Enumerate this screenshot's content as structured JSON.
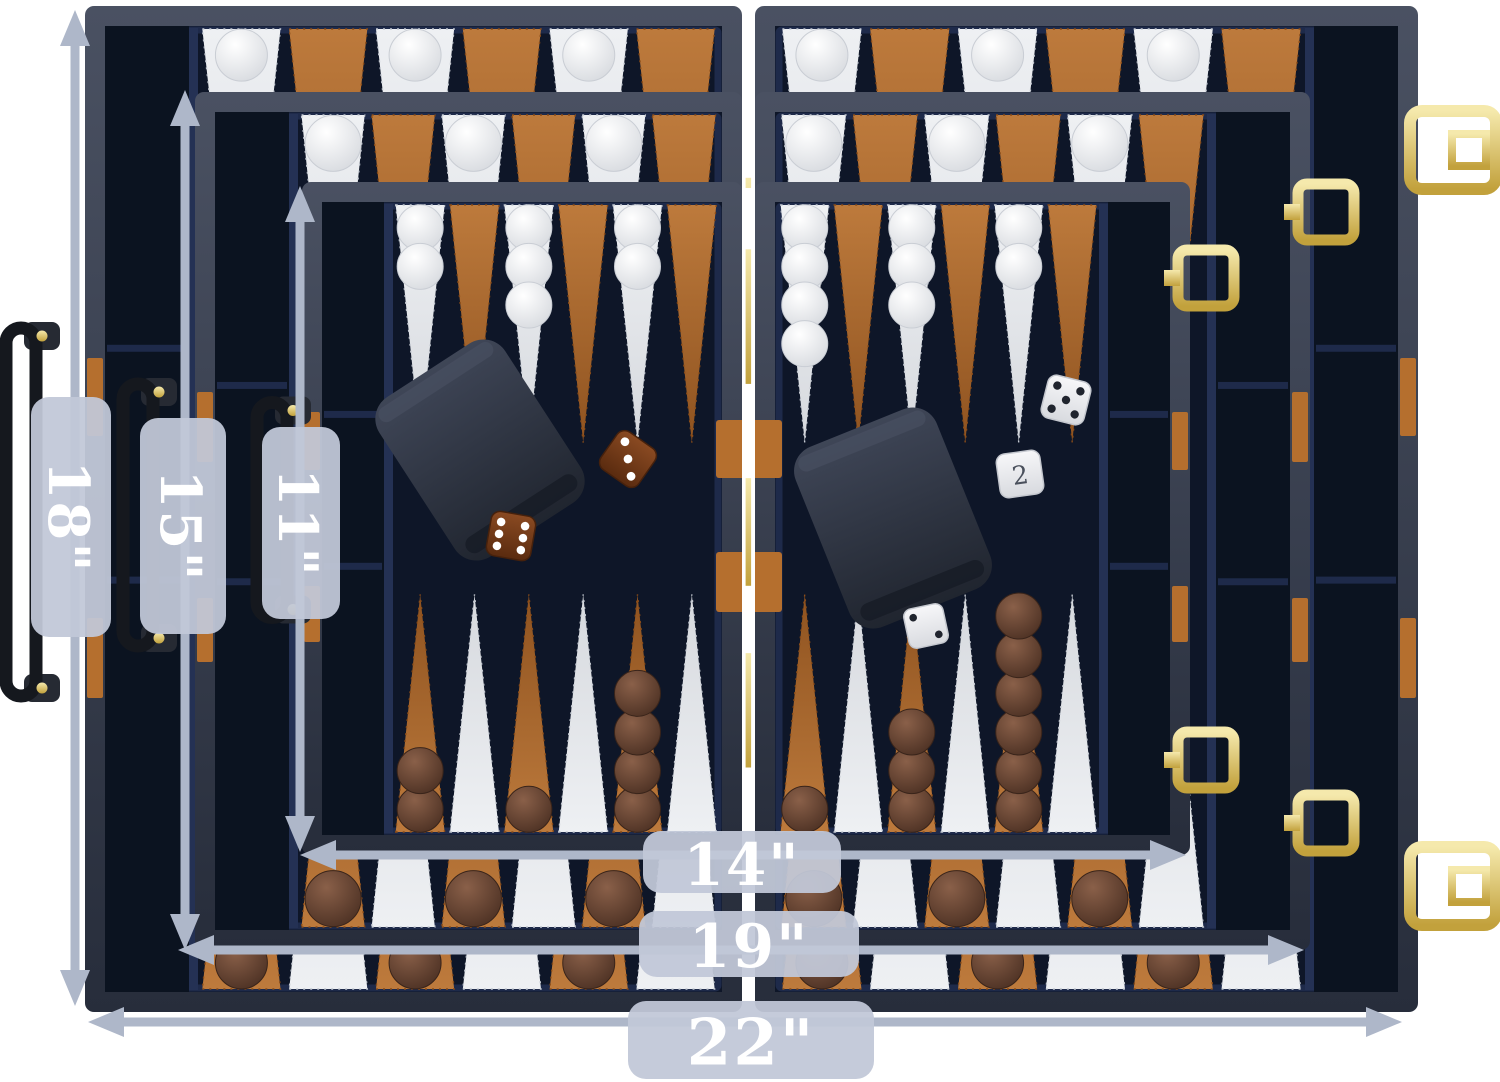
{
  "image_type": "product-photo",
  "subject": "Three nested folding backgammon cases shown open for size comparison",
  "dimension_labels": {
    "h18": "18\"",
    "h15": "15\"",
    "h11": "11\"",
    "w14": "14\"",
    "w19": "19\"",
    "w22": "22\""
  },
  "doubling_cube": {
    "value": "2"
  },
  "dice_values": {
    "brown_dice": [
      3,
      6
    ],
    "white_dice": [
      5,
      2
    ]
  },
  "colors": {
    "background": "#ffffff",
    "frame_top": "#4a5162",
    "frame_bottom": "#272d3b",
    "felt": "#0e1628",
    "tray": "#0b1320",
    "wall": "#1e2a4a",
    "wall2": "#243154",
    "point_white": "#eef0f3",
    "point_white_dark": "#d6d9de",
    "point_brown": "#bd7a3c",
    "point_brown_dark": "#8f5320",
    "checker_white": "#f6f6f8",
    "checker_brown": "#7e5742",
    "gold_light": "#f5e9ac",
    "gold_dark": "#c2a13c",
    "tan": "#b56f2e",
    "cup_top": "#3f4657",
    "cup_bottom": "#20252f",
    "die_brown": "#82451f",
    "die_white": "#f6f6f8",
    "arrow": "#aeb7c9",
    "pill": "#c1c8d8",
    "label_text": "#ffffff"
  },
  "scene": {
    "canvas": {
      "w": 1500,
      "h": 1082
    },
    "boards": [
      {
        "name": "22in-case",
        "left": {
          "x": 85,
          "y": 6,
          "w": 657,
          "h": 1006
        },
        "right": {
          "x": 755,
          "y": 6,
          "w": 663,
          "h": 1006
        },
        "tray": 84,
        "ck": 52,
        "ts_l": [
          1,
          0,
          1,
          0,
          1,
          0
        ],
        "ts_r": [
          1,
          0,
          1,
          0,
          1,
          0
        ],
        "bs_l": [
          1,
          0,
          1,
          0,
          1,
          0
        ],
        "bs_r": [
          1,
          0,
          1,
          0,
          1,
          0
        ],
        "handle": {
          "cx": 20,
          "cy": 512,
          "len": 368
        },
        "latch_y": [
          150,
          886
        ],
        "accents": [
          [
            358,
            436
          ],
          [
            618,
            698
          ]
        ],
        "bar_straps": []
      },
      {
        "name": "19in-case",
        "left": {
          "x": 195,
          "y": 92,
          "w": 547,
          "h": 858
        },
        "right": {
          "x": 755,
          "y": 92,
          "w": 555,
          "h": 858
        },
        "tray": 74,
        "ck": 56,
        "ts_l": [
          1,
          0,
          1,
          0,
          1,
          0
        ],
        "ts_r": [
          1,
          0,
          1,
          0,
          1,
          0
        ],
        "bs_l": [
          1,
          0,
          1,
          0,
          1,
          0
        ],
        "bs_r": [
          1,
          0,
          1,
          0,
          1,
          0
        ],
        "handle": {
          "cx": 137,
          "cy": 515,
          "len": 262
        },
        "clasp_y": [
          212,
          823
        ],
        "accents": [
          [
            392,
            462
          ],
          [
            598,
            662
          ]
        ],
        "bar_straps": []
      },
      {
        "name": "14in-case",
        "left": {
          "x": 302,
          "y": 182,
          "w": 440,
          "h": 673
        },
        "right": {
          "x": 755,
          "y": 182,
          "w": 435,
          "h": 673
        },
        "tray": 62,
        "ck": 46,
        "ts_l": [
          2,
          0,
          3,
          0,
          2,
          0
        ],
        "ts_r": [
          4,
          0,
          3,
          0,
          2,
          0
        ],
        "bs_l": [
          2,
          0,
          1,
          0,
          4,
          0
        ],
        "bs_r": [
          1,
          0,
          3,
          0,
          6,
          0
        ],
        "handle": {
          "cx": 271,
          "cy": 510,
          "len": 215
        },
        "clasp_y": [
          278,
          760
        ],
        "accents": [
          [
            412,
            470
          ],
          [
            586,
            642
          ]
        ],
        "bar_straps": [
          [
            420,
            478
          ],
          [
            552,
            612
          ]
        ]
      }
    ],
    "cups": [
      {
        "cx": 480,
        "cy": 450,
        "w": 150,
        "h": 190,
        "rot": -33
      },
      {
        "cx": 893,
        "cy": 518,
        "w": 152,
        "h": 194,
        "rot": -22
      }
    ],
    "dice": [
      {
        "cx": 628,
        "cy": 459,
        "s": 46,
        "rot": 35,
        "color": "brown",
        "pips": 3
      },
      {
        "cx": 511,
        "cy": 536,
        "s": 45,
        "rot": 10,
        "color": "brown",
        "pips": 6
      },
      {
        "cx": 1066,
        "cy": 400,
        "s": 44,
        "rot": 14,
        "color": "white",
        "pips": 5
      },
      {
        "cx": 926,
        "cy": 626,
        "s": 40,
        "rot": -12,
        "color": "white",
        "pips": 2
      }
    ],
    "doubling_cube": {
      "cx": 1020,
      "cy": 474,
      "s": 44,
      "rot": -8
    },
    "arrows": {
      "v": [
        {
          "x": 75,
          "y1": 10,
          "y2": 1006,
          "key": "h18"
        },
        {
          "x": 185,
          "y1": 90,
          "y2": 950,
          "key": "h15"
        },
        {
          "x": 300,
          "y1": 186,
          "y2": 852,
          "key": "h11"
        }
      ],
      "h": [
        {
          "y": 855,
          "x1": 300,
          "x2": 1186,
          "key": "w14"
        },
        {
          "y": 950,
          "x1": 178,
          "x2": 1304,
          "key": "w19"
        },
        {
          "y": 1022,
          "x1": 88,
          "x2": 1402,
          "key": "w22"
        }
      ]
    },
    "pills": {
      "v": [
        {
          "cx": 71,
          "cy": 517,
          "w": 80,
          "h": 240,
          "fs": 56,
          "key": "h18"
        },
        {
          "cx": 183,
          "cy": 526,
          "w": 86,
          "h": 216,
          "fs": 56,
          "key": "h15"
        },
        {
          "cx": 301,
          "cy": 523,
          "w": 78,
          "h": 192,
          "fs": 54,
          "key": "h11"
        }
      ],
      "h": [
        {
          "cx": 742,
          "cy": 862,
          "w": 198,
          "h": 62,
          "fs": 58,
          "key": "w14"
        },
        {
          "cx": 749,
          "cy": 944,
          "w": 220,
          "h": 66,
          "fs": 60,
          "key": "w19"
        },
        {
          "cx": 751,
          "cy": 1040,
          "w": 246,
          "h": 78,
          "fs": 64,
          "key": "w22"
        }
      ]
    }
  }
}
